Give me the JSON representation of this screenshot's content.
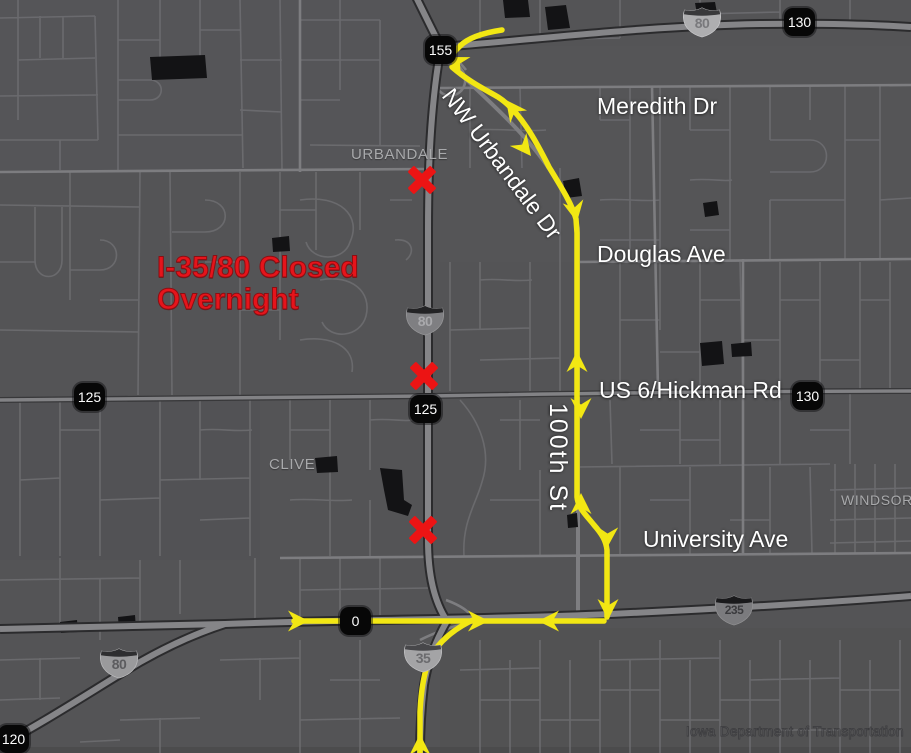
{
  "map": {
    "closure_notice": {
      "line1": "I-35/80 Closed",
      "line2": "Overnight"
    },
    "street_labels": [
      {
        "text": "Meredith Dr"
      },
      {
        "text": "Douglas Ave"
      },
      {
        "text": "US 6/Hickman Rd"
      },
      {
        "text": "University Ave"
      },
      {
        "text": "NW Urbandale Dr"
      },
      {
        "text": "100th St"
      }
    ],
    "city_labels": [
      {
        "text": "URBANDALE"
      },
      {
        "text": "CLIVE"
      },
      {
        "text": "WINDSOR H"
      }
    ],
    "exit_markers": [
      {
        "num": "155"
      },
      {
        "num": "130"
      },
      {
        "num": "125"
      },
      {
        "num": "125"
      },
      {
        "num": "130"
      },
      {
        "num": "0"
      },
      {
        "num": "120"
      }
    ],
    "interstate_shields": [
      {
        "num": "80"
      },
      {
        "num": "80"
      },
      {
        "num": "235"
      },
      {
        "num": "35"
      },
      {
        "num": "80"
      }
    ],
    "watermark": "Iowa Department of Transportation",
    "colors": {
      "detour_yellow": "#f2e713",
      "closure_red": "#ec1414",
      "map_background": "#545456"
    }
  }
}
